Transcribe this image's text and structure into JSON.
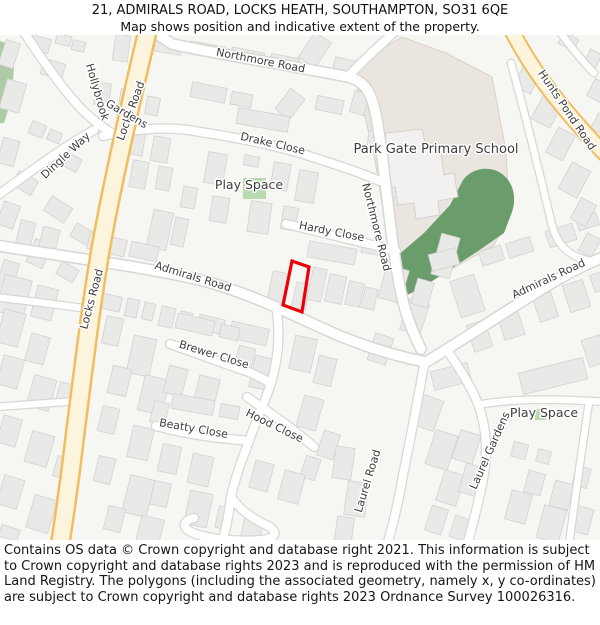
{
  "header": {
    "line1": "21, ADMIRALS ROAD, LOCKS HEATH, SOUTHAMPTON, SO31 6QE",
    "line2": "Map shows position and indicative extent of the property."
  },
  "footer": {
    "text": "Contains OS data © Crown copyright and database right 2021. This information is subject to Crown copyright and database rights 2023 and is reproduced with the permission of HM Land Registry. The polygons (including the associated geometry, namely x, y co-ordinates) are subject to Crown copyright and database rights 2023 Ordnance Survey 100026316."
  },
  "map": {
    "colors": {
      "bg": "#f6f6f3",
      "building": "#e9e9e7",
      "buildingStroke": "#d2d2d0",
      "roadFill": "#ffffff",
      "roadCasing": "#d7d7d5",
      "yellowFill": "#fdf4dd",
      "yellowCasing": "#f0bd60",
      "schoolFill": "#eae5de",
      "schoolStroke": "#d9d2c7",
      "green": "#6b9c6b",
      "lightGreen": "#b9d9b0",
      "leftGreen": "#aecaa7",
      "schoolBuilding": "#f2f1ef",
      "label": "#3d3d3d",
      "halo": "#ffffff",
      "property": "#ee0008"
    },
    "areas": {
      "leftGreen": "M0,6 L8,9 L14,30 L12,62 L4,88 L0,88 Z",
      "school": "M352,32 L402,2 L446,18 L492,42 L506,116 L509,180 L494,210 L455,232 L418,254 L400,263 L394,240 L384,180 L374,120 L362,70 Z",
      "greenMain": "M388,252 L396,222 L424,198 L450,170 L463,145 C472,133 490,130 502,139 C513,147 517,162 512,177 L504,198 L478,216 L446,237 L418,255 L398,264 Z",
      "schoolBuilding": "M386,98 L422,94 L426,112 L440,110 L444,140 L454,138 L458,162 L438,166 L440,180 L416,184 L414,168 L398,170 L395,152 L383,154 Z",
      "playTop": [
        243,
        143,
        23,
        21
      ],
      "playBottomIcon": [
        535,
        374,
        11,
        11
      ]
    },
    "roads": [
      {
        "n": "northmore-road",
        "t": "w",
        "d": "M150,-6 L172,9 C222,20 300,32 348,42 C366,46 372,60 376,80 C382,112 384,140 388,170 C392,205 396,235 402,262 C406,280 412,296 421,314"
      },
      {
        "n": "northmore-branch",
        "t": "m",
        "d": "M348,42 C360,28 380,10 398,-6"
      },
      {
        "n": "admirals-road-west",
        "t": "w",
        "d": "M-6,210 C60,221 140,231 200,245 C252,258 300,284 340,301 C372,314 400,322 426,327"
      },
      {
        "n": "admirals-road-east",
        "t": "w",
        "d": "M426,327 C456,309 500,280 545,252 C566,239 586,229 606,221"
      },
      {
        "n": "drake-close",
        "t": "m",
        "d": "M103,101 C140,93 170,91 200,97 C240,103 282,112 312,122 C334,129 356,136 380,146"
      },
      {
        "n": "hollybrook-gardens",
        "t": "m",
        "d": "M22,-6 C35,14 55,44 75,67 C90,84 108,97 124,105"
      },
      {
        "n": "dingle-way",
        "t": "m",
        "d": "M-6,163 C26,140 60,114 94,95"
      },
      {
        "n": "hardy-close",
        "t": "m",
        "d": "M286,189 C312,195 340,202 364,208 C374,210 386,213 396,216"
      },
      {
        "n": "mid-south-road",
        "t": "m",
        "d": "M276,271 C281,300 278,330 268,357 C259,380 252,397 246,414 C240,430 234,447 231,462 C229,477 227,490 224,500"
      },
      {
        "n": "turning-loop",
        "t": "m",
        "d": "M231,462 C241,477 256,485 268,491 C279,497 276,504 260,505 C236,507 206,504 191,497 C181,492 184,485 194,483"
      },
      {
        "n": "hood-close",
        "t": "m",
        "d": "M247,362 C270,378 294,394 314,412"
      },
      {
        "n": "beatty-close",
        "t": "m",
        "d": "M156,391 C182,398 206,402 230,404 C236,405 242,405 248,406"
      },
      {
        "n": "brewer-close",
        "t": "m",
        "d": "M170,309 C196,318 222,328 246,336 C254,339 262,343 270,348"
      },
      {
        "n": "laurel-road",
        "t": "m",
        "d": "M424,330 C419,360 411,400 403,440 C398,470 393,490 387,510"
      },
      {
        "n": "laurel-gardens",
        "t": "m",
        "d": "M447,315 C459,333 471,351 478,369 C486,391 488,414 484,439 C480,462 474,485 467,510"
      },
      {
        "n": "laurel-gardens-east",
        "t": "s",
        "d": "M483,369 C520,363 560,364 606,367"
      },
      {
        "n": "right-edge-road",
        "t": "s",
        "d": "M589,367 C584,400 578,440 569,510"
      },
      {
        "n": "school-side-road",
        "t": "s",
        "d": "M511,28 C524,74 540,140 552,190 C558,213 572,223 592,226"
      },
      {
        "n": "west-stub-1",
        "t": "s",
        "d": "M-6,262 C30,266 60,270 90,274"
      },
      {
        "n": "west-stub-2",
        "t": "s",
        "d": "M-6,372 C25,370 50,368 78,366"
      },
      {
        "n": "topright-stub",
        "t": "s",
        "d": "M558,-6 C568,8 580,24 594,38"
      },
      {
        "n": "locks-road",
        "t": "yl",
        "d": "M148,-6 C132,62 112,150 101,212 C91,270 84,330 76,392 C71,436 66,472 60,510"
      },
      {
        "n": "hunts-pond-road",
        "t": "ys",
        "d": "M511,-6 C528,28 554,66 606,120"
      }
    ],
    "buildings": [
      [
        2,
        6,
        15,
        26,
        18
      ],
      [
        30,
        2,
        20,
        14,
        15
      ],
      [
        56,
        0,
        15,
        10,
        12
      ],
      [
        3,
        46,
        20,
        30,
        16
      ],
      [
        42,
        26,
        22,
        16,
        16
      ],
      [
        72,
        6,
        13,
        10,
        14
      ],
      [
        30,
        88,
        15,
        13,
        22
      ],
      [
        48,
        96,
        13,
        11,
        22
      ],
      [
        0,
        104,
        17,
        26,
        15
      ],
      [
        62,
        120,
        18,
        14,
        28
      ],
      [
        14,
        140,
        22,
        16,
        30
      ],
      [
        0,
        168,
        17,
        24,
        20
      ],
      [
        46,
        166,
        24,
        17,
        32
      ],
      [
        72,
        192,
        21,
        15,
        30
      ],
      [
        30,
        206,
        18,
        25,
        24
      ],
      [
        0,
        226,
        16,
        27,
        18
      ],
      [
        58,
        230,
        19,
        14,
        30
      ],
      [
        114,
        0,
        15,
        26,
        8
      ],
      [
        140,
        2,
        42,
        15,
        9
      ],
      [
        190,
        9,
        35,
        13,
        10
      ],
      [
        231,
        15,
        33,
        13,
        11
      ],
      [
        270,
        21,
        29,
        12,
        11
      ],
      [
        305,
        0,
        20,
        30,
        33
      ],
      [
        334,
        24,
        22,
        12,
        12
      ],
      [
        95,
        48,
        15,
        22,
        8
      ],
      [
        119,
        55,
        19,
        26,
        10
      ],
      [
        146,
        62,
        13,
        18,
        10
      ],
      [
        191,
        50,
        35,
        15,
        11
      ],
      [
        231,
        58,
        21,
        13,
        11
      ],
      [
        281,
        56,
        18,
        26,
        38
      ],
      [
        316,
        63,
        27,
        14,
        12
      ],
      [
        352,
        57,
        15,
        22,
        16
      ],
      [
        237,
        77,
        52,
        16,
        10
      ],
      [
        129,
        96,
        15,
        24,
        9
      ],
      [
        152,
        102,
        17,
        25,
        10
      ],
      [
        206,
        118,
        19,
        31,
        10
      ],
      [
        244,
        121,
        15,
        10,
        10
      ],
      [
        272,
        128,
        17,
        27,
        10
      ],
      [
        297,
        136,
        19,
        31,
        10
      ],
      [
        131,
        126,
        16,
        27,
        10
      ],
      [
        157,
        132,
        14,
        23,
        10
      ],
      [
        182,
        152,
        14,
        21,
        10
      ],
      [
        211,
        162,
        17,
        25,
        9
      ],
      [
        249,
        167,
        21,
        31,
        8
      ],
      [
        282,
        172,
        15,
        23,
        9
      ],
      [
        308,
        210,
        48,
        16,
        10
      ],
      [
        362,
        206,
        20,
        13,
        10
      ],
      [
        436,
        200,
        19,
        42,
        15
      ],
      [
        382,
        232,
        23,
        34,
        16
      ],
      [
        404,
        266,
        21,
        32,
        18
      ],
      [
        414,
        245,
        17,
        26,
        16
      ],
      [
        371,
        300,
        19,
        28,
        18
      ],
      [
        150,
        176,
        20,
        38,
        12
      ],
      [
        173,
        183,
        13,
        28,
        12
      ],
      [
        270,
        237,
        17,
        30,
        12
      ],
      [
        294,
        248,
        14,
        26,
        12
      ],
      [
        310,
        233,
        14,
        33,
        12
      ],
      [
        327,
        240,
        17,
        28,
        12
      ],
      [
        347,
        247,
        15,
        24,
        12
      ],
      [
        363,
        253,
        13,
        21,
        12
      ],
      [
        18,
        186,
        15,
        26,
        14
      ],
      [
        40,
        193,
        17,
        28,
        14
      ],
      [
        88,
        201,
        38,
        17,
        13
      ],
      [
        130,
        209,
        28,
        15,
        12
      ],
      [
        0,
        242,
        28,
        38,
        14
      ],
      [
        34,
        252,
        21,
        32,
        14
      ],
      [
        100,
        260,
        21,
        15,
        13
      ],
      [
        126,
        264,
        12,
        18,
        13
      ],
      [
        143,
        268,
        11,
        17,
        13
      ],
      [
        160,
        272,
        14,
        20,
        13
      ],
      [
        179,
        277,
        12,
        17,
        13
      ],
      [
        198,
        282,
        26,
        15,
        13
      ],
      [
        230,
        290,
        38,
        17,
        13
      ],
      [
        0,
        276,
        22,
        34,
        15
      ],
      [
        28,
        300,
        19,
        28,
        15
      ],
      [
        0,
        322,
        21,
        30,
        15
      ],
      [
        30,
        342,
        23,
        32,
        16
      ],
      [
        58,
        348,
        13,
        19,
        16
      ],
      [
        0,
        382,
        19,
        28,
        16
      ],
      [
        28,
        398,
        23,
        32,
        16
      ],
      [
        55,
        422,
        15,
        21,
        16
      ],
      [
        0,
        442,
        21,
        30,
        17
      ],
      [
        30,
        462,
        23,
        34,
        17
      ],
      [
        0,
        492,
        19,
        12,
        17
      ],
      [
        104,
        282,
        17,
        28,
        12
      ],
      [
        130,
        302,
        23,
        38,
        12
      ],
      [
        110,
        332,
        19,
        28,
        13
      ],
      [
        141,
        342,
        25,
        36,
        13
      ],
      [
        100,
        372,
        17,
        26,
        13
      ],
      [
        130,
        392,
        21,
        32,
        13
      ],
      [
        96,
        422,
        17,
        26,
        14
      ],
      [
        126,
        442,
        25,
        38,
        14
      ],
      [
        106,
        472,
        17,
        24,
        14
      ],
      [
        138,
        482,
        23,
        32,
        14
      ],
      [
        176,
        282,
        38,
        15,
        13
      ],
      [
        220,
        291,
        19,
        13,
        13
      ],
      [
        166,
        332,
        19,
        28,
        14
      ],
      [
        196,
        342,
        21,
        30,
        14
      ],
      [
        152,
        367,
        15,
        22,
        14
      ],
      [
        172,
        362,
        42,
        15,
        10
      ],
      [
        220,
        370,
        19,
        13,
        10
      ],
      [
        160,
        410,
        19,
        28,
        12
      ],
      [
        190,
        420,
        21,
        30,
        12
      ],
      [
        152,
        447,
        17,
        24,
        12
      ],
      [
        187,
        457,
        23,
        34,
        12
      ],
      [
        217,
        472,
        15,
        22,
        12
      ],
      [
        242,
        482,
        19,
        28,
        12
      ],
      [
        236,
        312,
        17,
        26,
        14
      ],
      [
        252,
        322,
        20,
        32,
        13
      ],
      [
        292,
        302,
        22,
        34,
        12
      ],
      [
        316,
        322,
        18,
        28,
        14
      ],
      [
        300,
        362,
        20,
        32,
        16
      ],
      [
        320,
        397,
        17,
        26,
        18
      ],
      [
        303,
        422,
        15,
        22,
        18
      ],
      [
        252,
        427,
        19,
        28,
        15
      ],
      [
        281,
        437,
        21,
        30,
        15
      ],
      [
        334,
        412,
        19,
        32,
        8
      ],
      [
        346,
        447,
        21,
        34,
        8
      ],
      [
        336,
        482,
        17,
        24,
        8
      ],
      [
        418,
        362,
        21,
        32,
        20
      ],
      [
        430,
        397,
        23,
        36,
        18
      ],
      [
        440,
        437,
        21,
        32,
        18
      ],
      [
        428,
        472,
        17,
        26,
        18
      ],
      [
        452,
        482,
        15,
        22,
        18
      ],
      [
        456,
        397,
        21,
        30,
        18
      ],
      [
        462,
        430,
        20,
        30,
        16
      ],
      [
        520,
        330,
        66,
        22,
        -14
      ],
      [
        432,
        332,
        38,
        19,
        -14
      ],
      [
        585,
        302,
        19,
        28,
        -18
      ],
      [
        512,
        408,
        15,
        15,
        15
      ],
      [
        537,
        415,
        13,
        13,
        15
      ],
      [
        526,
        437,
        17,
        22,
        15
      ],
      [
        552,
        447,
        19,
        26,
        15
      ],
      [
        574,
        432,
        15,
        20,
        15
      ],
      [
        508,
        457,
        21,
        30,
        15
      ],
      [
        540,
        472,
        23,
        34,
        15
      ],
      [
        572,
        472,
        19,
        26,
        15
      ],
      [
        480,
        213,
        23,
        15,
        -18
      ],
      [
        507,
        205,
        25,
        15,
        -18
      ],
      [
        547,
        192,
        28,
        17,
        -18
      ],
      [
        577,
        180,
        21,
        13,
        -18
      ],
      [
        430,
        216,
        28,
        17,
        -15
      ],
      [
        470,
        287,
        19,
        28,
        -18
      ],
      [
        500,
        273,
        21,
        30,
        -18
      ],
      [
        536,
        259,
        19,
        26,
        -18
      ],
      [
        566,
        247,
        21,
        28,
        -18
      ],
      [
        592,
        238,
        13,
        18,
        -18
      ],
      [
        455,
        242,
        25,
        38,
        -18
      ],
      [
        519,
        28,
        19,
        28,
        28
      ],
      [
        537,
        60,
        21,
        30,
        28
      ],
      [
        551,
        95,
        19,
        28,
        28
      ],
      [
        564,
        130,
        21,
        30,
        28
      ],
      [
        575,
        165,
        17,
        24,
        28
      ],
      [
        582,
        200,
        15,
        20,
        28
      ],
      [
        560,
        0,
        17,
        13,
        28
      ],
      [
        586,
        16,
        13,
        17,
        28
      ],
      [
        590,
        46,
        15,
        19,
        28
      ],
      [
        594,
        80,
        13,
        17,
        28
      ],
      [
        368,
        96,
        12,
        16,
        5
      ],
      [
        392,
        150,
        10,
        12,
        0
      ]
    ],
    "property_outline": {
      "points": "292,226 309,232 302,277 283,270",
      "stroke_width": 3.2
    },
    "labels": [
      {
        "t": "Northmore Road",
        "x": 260,
        "y": 29,
        "r": 11,
        "s": 11
      },
      {
        "t": "Drake Close",
        "x": 272,
        "y": 112,
        "r": 13,
        "s": 11
      },
      {
        "t": "Play Space",
        "x": 249,
        "y": 154,
        "r": 0,
        "s": 12.5
      },
      {
        "t": "Park Gate Primary School",
        "x": 436,
        "y": 118,
        "r": 0,
        "s": 13
      },
      {
        "t": "Northmore Road",
        "x": 373,
        "y": 193,
        "r": 76,
        "s": 11
      },
      {
        "t": "Hunts Pond Road",
        "x": 564,
        "y": 77,
        "r": 56,
        "s": 11
      },
      {
        "t": "Hardy Close",
        "x": 331,
        "y": 200,
        "r": 11,
        "s": 11
      },
      {
        "t": "Admirals Road",
        "x": 192,
        "y": 245,
        "r": 17,
        "s": 11
      },
      {
        "t": "Admirals Road",
        "x": 550,
        "y": 247,
        "r": -25,
        "s": 11
      },
      {
        "t": "Locks Road",
        "x": 134,
        "y": 77,
        "r": -70,
        "s": 11
      },
      {
        "t": "Locks Road",
        "x": 95,
        "y": 265,
        "r": -75,
        "s": 11
      },
      {
        "t": "Hollybrook",
        "x": 94,
        "y": 58,
        "r": 74,
        "s": 11
      },
      {
        "t": "Gardens",
        "x": 125,
        "y": 82,
        "r": 30,
        "s": 11
      },
      {
        "t": "Dingle Way",
        "x": 68,
        "y": 123,
        "r": -43,
        "s": 11
      },
      {
        "t": "Brewer Close",
        "x": 213,
        "y": 323,
        "r": 17,
        "s": 11
      },
      {
        "t": "Hood Close",
        "x": 273,
        "y": 394,
        "r": 26,
        "s": 11
      },
      {
        "t": "Beatty Close",
        "x": 193,
        "y": 397,
        "r": 10,
        "s": 11
      },
      {
        "t": "Laurel Road",
        "x": 371,
        "y": 447,
        "r": -73,
        "s": 11
      },
      {
        "t": "Laurel Gardens",
        "x": 493,
        "y": 417,
        "r": -66,
        "s": 11
      },
      {
        "t": "Play Space",
        "x": 544,
        "y": 382,
        "r": 0,
        "s": 12.5
      }
    ]
  }
}
